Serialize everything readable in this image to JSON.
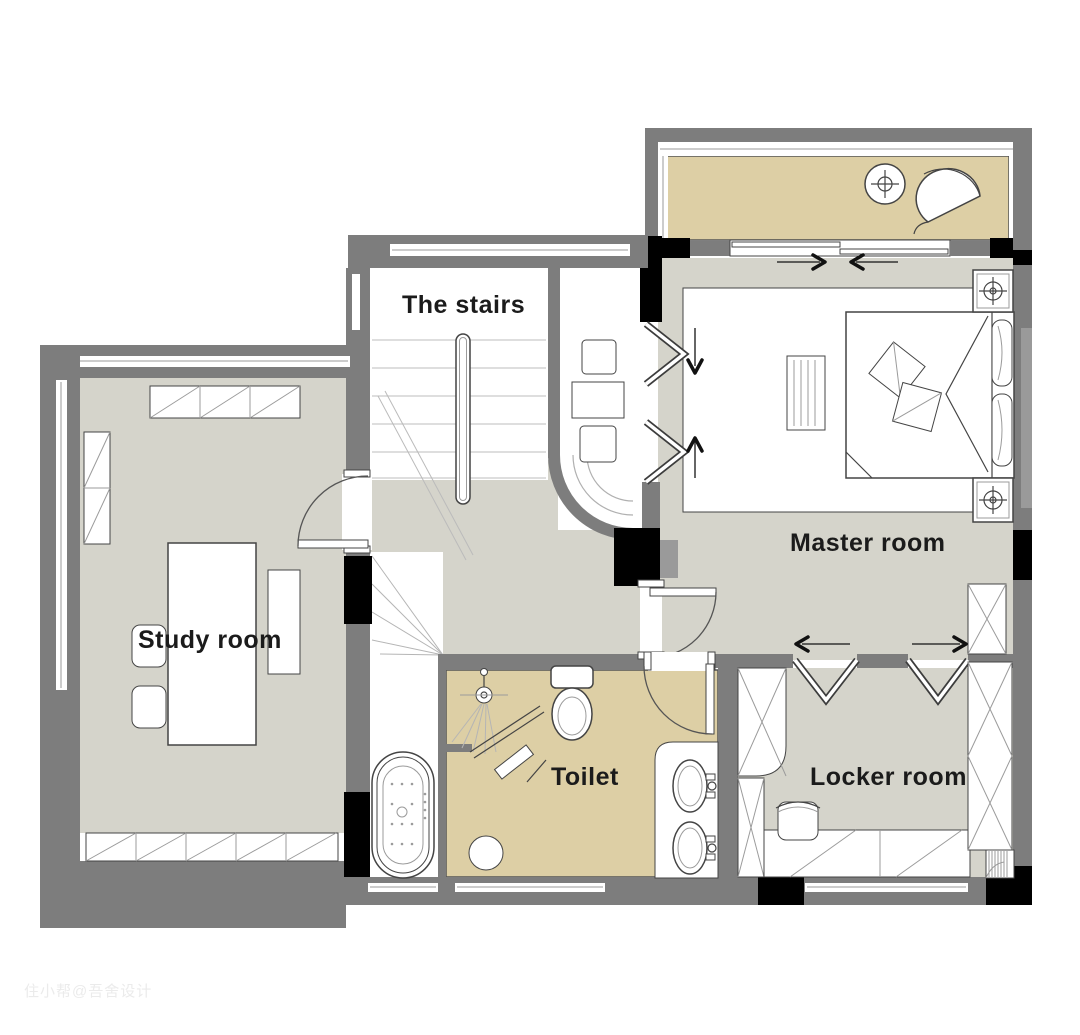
{
  "rooms": {
    "stairs": {
      "label": "The stairs"
    },
    "master": {
      "label": "Master room"
    },
    "study": {
      "label": "Study room"
    },
    "toilet": {
      "label": "Toilet"
    },
    "locker": {
      "label": "Locker room"
    }
  },
  "watermark": "住小帮@吾舍设计",
  "colors": {
    "wall": "#7d7d7d",
    "wall_light": "#9a9a9a",
    "column": "#000000",
    "floor": "#d5d4cb",
    "accent_floor": "#ddcfa5",
    "outline": "#444444",
    "tread": "#c9c9c9",
    "label_text": "#1b1b1b",
    "watermark": "#ebebeb",
    "background": "#ffffff"
  },
  "fixtures": {
    "balcony": [
      "round-side-table",
      "lounge-chair",
      "sliding-door",
      "sliding-door-arrows"
    ],
    "master_room": [
      "double-bed",
      "pillows",
      "nightstand-top",
      "nightstand-bottom",
      "tv-bench",
      "rug",
      "bifold-closet-doors",
      "bifold-door-arrows",
      "dressing-table",
      "corner-cabinet"
    ],
    "stairs": [
      "straight-treads",
      "handrail",
      "break-line",
      "winder-treads",
      "curved-wall"
    ],
    "toilet": [
      "shower-head",
      "glass-screen",
      "shower-bench",
      "toilet-bowl",
      "double-basin-counter",
      "floor-stool",
      "bathtub",
      "entry-door"
    ],
    "locker_room": [
      "wardrobe-left",
      "wardrobe-right",
      "dressing-counter",
      "stool",
      "roller-blind",
      "folding-doors",
      "folding-door-arrows"
    ],
    "study_room": [
      "top-shelf-cabinet",
      "wall-cabinet",
      "desk",
      "side-table",
      "chairs",
      "window-seat-cabinet",
      "entry-door"
    ]
  }
}
